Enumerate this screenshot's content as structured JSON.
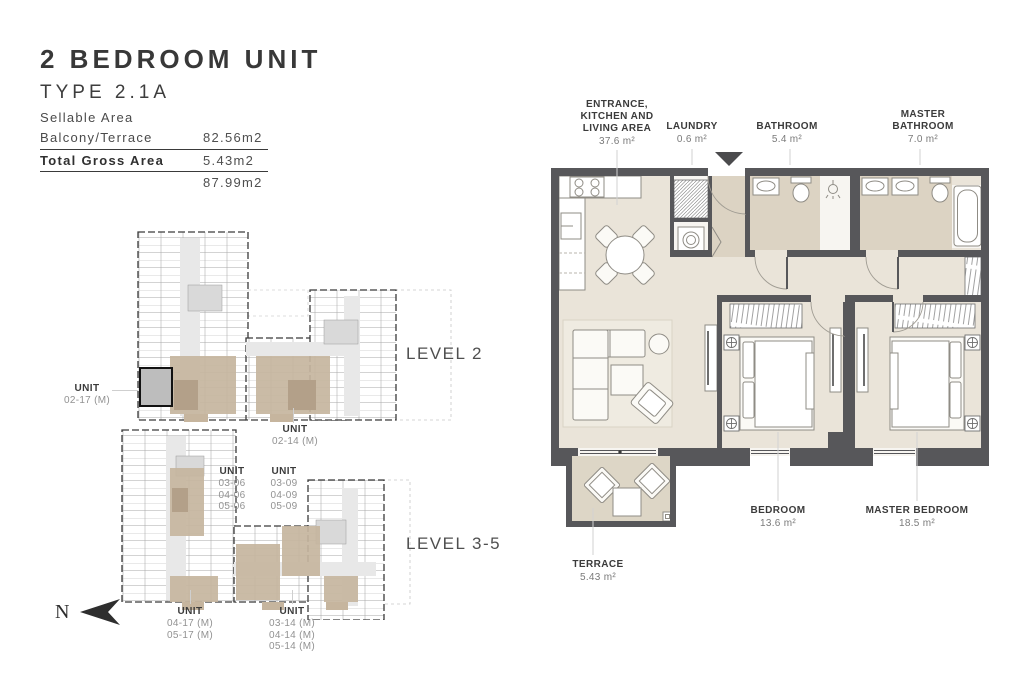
{
  "title_block": {
    "title": "2 BEDROOM UNIT",
    "type": "TYPE 2.1A",
    "area_rows": [
      {
        "label": "Sellable Area",
        "value": ""
      },
      {
        "label": "Balcony/Terrace",
        "value": "82.56m2"
      },
      {
        "label": "Total Gross Area",
        "value": "5.43m2"
      },
      {
        "label": "",
        "value": "87.99m2"
      }
    ]
  },
  "key_plans": {
    "level2": {
      "label": "LEVEL 2",
      "unit_left": {
        "title": "UNIT",
        "numbers": "02-17 (M)"
      },
      "unit_bottom": {
        "title": "UNIT",
        "numbers": "02-14 (M)"
      }
    },
    "level35": {
      "label": "LEVEL 3-5",
      "unit_a": {
        "title": "UNIT",
        "numbers": "03-06\n04-06\n05-06"
      },
      "unit_b": {
        "title": "UNIT",
        "numbers": "03-09\n04-09\n05-09"
      },
      "unit_c": {
        "title": "UNIT",
        "numbers": "04-17 (M)\n05-17 (M)"
      },
      "unit_d": {
        "title": "UNIT",
        "numbers": "03-14 (M)\n04-14 (M)\n05-14 (M)"
      }
    }
  },
  "compass": {
    "north_label": "N"
  },
  "floor_plan": {
    "rooms": {
      "entrance": {
        "name": "ENTRANCE,\nKITCHEN AND\nLIVING AREA",
        "area": "37.6 m²"
      },
      "laundry": {
        "name": "LAUNDRY",
        "area": "0.6 m²"
      },
      "bathroom": {
        "name": "BATHROOM",
        "area": "5.4 m²"
      },
      "master_bathroom": {
        "name": "MASTER\nBATHROOM",
        "area": "7.0 m²"
      },
      "bedroom": {
        "name": "BEDROOM",
        "area": "13.6 m²"
      },
      "master_bedroom": {
        "name": "MASTER BEDROOM",
        "area": "18.5 m²"
      },
      "terrace": {
        "name": "TERRACE",
        "area": "5.43 m²"
      }
    }
  },
  "colors": {
    "wall": "#57575A",
    "floor": "#EAE4D9",
    "bath_floor": "#DCD3C3",
    "terrace_floor": "#DDD6C6",
    "unit_highlight_tan": "#C6B59E",
    "unit_highlight_gray": "#BDBDBD",
    "text_dark": "#3D3D3D",
    "text_muted": "#8F8F8F"
  }
}
